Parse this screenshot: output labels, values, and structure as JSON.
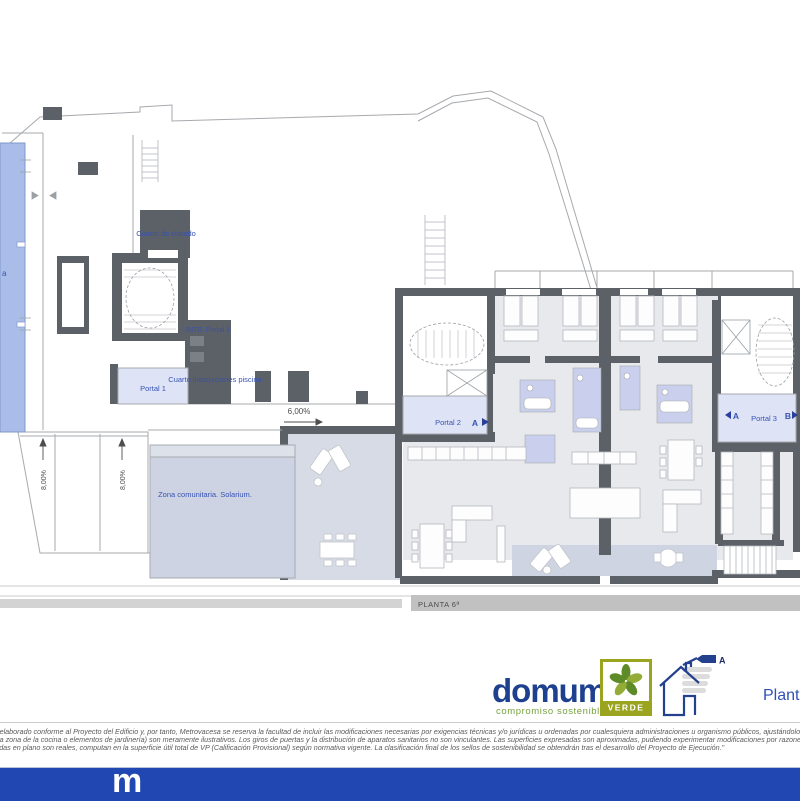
{
  "plan": {
    "labels": {
      "pool_fragment": "a",
      "cuarto_clorado": "Cuarto de clorado",
      "rits": "RITS. Portal 1",
      "cuarto_instalaciones_piscina": "Cuarto instalaciones piscina",
      "portal_1": "Portal 1",
      "portal_2": "Portal 2",
      "portal_2_marker": "A",
      "portal_3": "Portal 3",
      "portal_3_marker_a": "A",
      "portal_3_marker_b": "B",
      "zona_comunitaria": "Zona comunitaria. Solarium.",
      "slope_6": "6,00%",
      "slope_8_left": "8,00%",
      "slope_8_right": "8,00%",
      "planta_section": "PLANTA 6ª"
    },
    "colors": {
      "pool": "#a9bde8",
      "wall": "#5c6067",
      "outline": "#a6a9ad",
      "floor": "#e8e9ed",
      "bathroom": "#c9cfec",
      "lobby": "#dee4f6",
      "solarium": "#cdd3e2",
      "terrace": "#ced4e1",
      "label": "#3752b4"
    }
  },
  "branding": {
    "logo_prefix": "domu",
    "logo_suffix": "m",
    "tagline": "compromiso sostenible",
    "verde_label": "VERDE",
    "energy_rating": "A",
    "plan_caption": "Plant"
  },
  "footer": {
    "disclaimer_lines": [
      "ido elaborado conforme al Proyecto del Edificio y, por tanto, Metrovacesa se reserva la facultad de incluir las modificaciones necesarias por exigencias técnicas y/o jurídicas u ordenadas por cualesquiera administraciones u organismo públicos, ajustándolos en todo caso a",
      "en la zona de la cocina o elementos de jardinería) son meramente ilustrativos. Los giros de puertas y la distribución de aparatos sanitarios no son vinculantes. Las superficies expresadas son aproximadas, pudiendo experimentar modificaciones por razones de índole técnic",
      "lejadas en plano son reales, computan en la superficie útil total de VP (Calificación Provisional) según normativa vigente. La clasificación final de los sellos de sostenibilidad se obtendrán tras el desarrollo del Proyecto de Ejecución.\""
    ],
    "watermark": "m"
  }
}
